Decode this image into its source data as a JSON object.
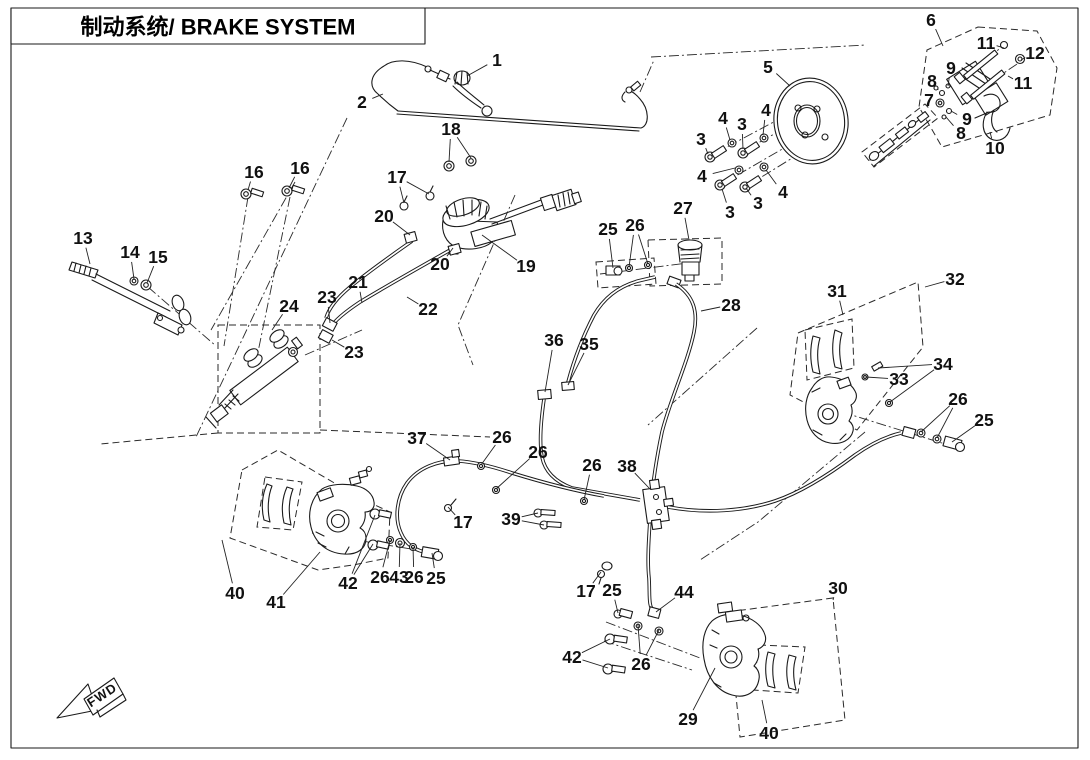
{
  "title": {
    "zh": "制动系统",
    "en": "BRAKE SYSTEM",
    "full": "制动系统/ BRAKE SYSTEM"
  },
  "fwd_label": "FWD",
  "colors": {
    "ink": "#1a1a1a",
    "background": "#ffffff"
  },
  "callouts": [
    {
      "n": "1",
      "x": 497,
      "y": 60,
      "t": [
        [
          467,
          76
        ]
      ]
    },
    {
      "n": "2",
      "x": 362,
      "y": 102,
      "t": [
        [
          383,
          94
        ]
      ]
    },
    {
      "n": "18",
      "x": 451,
      "y": 129,
      "t": [
        [
          449,
          162
        ],
        [
          471,
          158
        ]
      ]
    },
    {
      "n": "17",
      "x": 397,
      "y": 177,
      "t": [
        [
          404,
          203
        ],
        [
          429,
          194
        ]
      ]
    },
    {
      "n": "16",
      "x": 254,
      "y": 172,
      "t": [
        [
          248,
          190
        ]
      ]
    },
    {
      "n": "16",
      "x": 300,
      "y": 168,
      "t": [
        [
          289,
          188
        ]
      ]
    },
    {
      "n": "20",
      "x": 384,
      "y": 216,
      "t": [
        [
          410,
          235
        ]
      ]
    },
    {
      "n": "20",
      "x": 440,
      "y": 264,
      "t": [
        [
          453,
          248
        ]
      ]
    },
    {
      "n": "19",
      "x": 526,
      "y": 266,
      "t": [
        [
          482,
          235
        ]
      ]
    },
    {
      "n": "13",
      "x": 83,
      "y": 238,
      "t": [
        [
          90,
          264
        ]
      ]
    },
    {
      "n": "14",
      "x": 130,
      "y": 252,
      "t": [
        [
          134,
          279
        ]
      ]
    },
    {
      "n": "15",
      "x": 158,
      "y": 257,
      "t": [
        [
          147,
          283
        ]
      ]
    },
    {
      "n": "24",
      "x": 289,
      "y": 306,
      "t": [
        [
          272,
          330
        ]
      ]
    },
    {
      "n": "23",
      "x": 327,
      "y": 297,
      "t": [
        [
          330,
          323
        ]
      ]
    },
    {
      "n": "21",
      "x": 358,
      "y": 282,
      "t": [
        [
          362,
          303
        ]
      ]
    },
    {
      "n": "22",
      "x": 428,
      "y": 309,
      "t": [
        [
          407,
          297
        ]
      ]
    },
    {
      "n": "23",
      "x": 354,
      "y": 352,
      "t": [
        [
          332,
          340
        ]
      ]
    },
    {
      "n": "25",
      "x": 608,
      "y": 229,
      "t": [
        [
          613,
          268
        ]
      ]
    },
    {
      "n": "26",
      "x": 635,
      "y": 225,
      "t": [
        [
          629,
          267
        ],
        [
          648,
          264
        ]
      ]
    },
    {
      "n": "27",
      "x": 683,
      "y": 208,
      "t": [
        [
          689,
          240
        ]
      ]
    },
    {
      "n": "28",
      "x": 731,
      "y": 305,
      "t": [
        [
          701,
          311
        ]
      ]
    },
    {
      "n": "5",
      "x": 768,
      "y": 67,
      "t": [
        [
          790,
          86
        ]
      ]
    },
    {
      "n": "3",
      "x": 701,
      "y": 139,
      "t": [
        [
          708,
          154
        ]
      ]
    },
    {
      "n": "4",
      "x": 723,
      "y": 118,
      "t": [
        [
          730,
          140
        ]
      ]
    },
    {
      "n": "3",
      "x": 742,
      "y": 124,
      "t": [
        [
          743,
          149
        ]
      ]
    },
    {
      "n": "4",
      "x": 766,
      "y": 110,
      "t": [
        [
          763,
          135
        ]
      ]
    },
    {
      "n": "4",
      "x": 702,
      "y": 176,
      "t": [
        [
          735,
          168
        ]
      ]
    },
    {
      "n": "3",
      "x": 730,
      "y": 212,
      "t": [
        [
          722,
          189
        ]
      ]
    },
    {
      "n": "3",
      "x": 758,
      "y": 203,
      "t": [
        [
          746,
          188
        ]
      ]
    },
    {
      "n": "4",
      "x": 783,
      "y": 192,
      "t": [
        [
          766,
          170
        ]
      ]
    },
    {
      "n": "6",
      "x": 931,
      "y": 20,
      "t": [
        [
          943,
          46
        ]
      ]
    },
    {
      "n": "11",
      "x": 986,
      "y": 43,
      "t": [
        [
          1004,
          48
        ]
      ]
    },
    {
      "n": "12",
      "x": 1035,
      "y": 53,
      "t": [
        [
          1021,
          60
        ]
      ]
    },
    {
      "n": "9",
      "x": 951,
      "y": 68,
      "t": [
        [
          948,
          86
        ]
      ]
    },
    {
      "n": "8",
      "x": 932,
      "y": 81,
      "t": [
        [
          938,
          90
        ]
      ]
    },
    {
      "n": "11",
      "x": 1023,
      "y": 83,
      "t": [
        [
          1008,
          76
        ]
      ]
    },
    {
      "n": "7",
      "x": 929,
      "y": 100,
      "t": [
        [
          939,
          103
        ]
      ]
    },
    {
      "n": "9",
      "x": 967,
      "y": 119,
      "t": [
        [
          951,
          111
        ]
      ]
    },
    {
      "n": "8",
      "x": 961,
      "y": 133,
      "t": [
        [
          946,
          117
        ]
      ]
    },
    {
      "n": "10",
      "x": 995,
      "y": 148,
      "t": [
        [
          990,
          132
        ]
      ]
    },
    {
      "n": "31",
      "x": 837,
      "y": 291,
      "t": [
        [
          843,
          315
        ]
      ]
    },
    {
      "n": "32",
      "x": 955,
      "y": 279,
      "t": [
        [
          925,
          287
        ]
      ]
    },
    {
      "n": "33",
      "x": 899,
      "y": 379,
      "t": [
        [
          866,
          377
        ]
      ]
    },
    {
      "n": "34",
      "x": 943,
      "y": 364,
      "t": [
        [
          878,
          368
        ],
        [
          890,
          402
        ]
      ]
    },
    {
      "n": "26",
      "x": 958,
      "y": 399,
      "t": [
        [
          921,
          432
        ],
        [
          937,
          438
        ]
      ]
    },
    {
      "n": "25",
      "x": 984,
      "y": 420,
      "t": [
        [
          952,
          442
        ]
      ]
    },
    {
      "n": "36",
      "x": 554,
      "y": 340,
      "t": [
        [
          545,
          392
        ]
      ]
    },
    {
      "n": "35",
      "x": 589,
      "y": 344,
      "t": [
        [
          568,
          385
        ]
      ]
    },
    {
      "n": "37",
      "x": 417,
      "y": 438,
      "t": [
        [
          450,
          460
        ]
      ]
    },
    {
      "n": "26",
      "x": 502,
      "y": 437,
      "t": [
        [
          481,
          465
        ]
      ]
    },
    {
      "n": "26",
      "x": 538,
      "y": 452,
      "t": [
        [
          496,
          489
        ]
      ]
    },
    {
      "n": "26",
      "x": 592,
      "y": 465,
      "t": [
        [
          584,
          500
        ]
      ]
    },
    {
      "n": "38",
      "x": 627,
      "y": 466,
      "t": [
        [
          650,
          489
        ]
      ]
    },
    {
      "n": "39",
      "x": 511,
      "y": 519,
      "t": [
        [
          538,
          513
        ],
        [
          544,
          525
        ]
      ]
    },
    {
      "n": "17",
      "x": 463,
      "y": 522,
      "t": [
        [
          448,
          507
        ]
      ]
    },
    {
      "n": "40",
      "x": 235,
      "y": 593,
      "t": [
        [
          222,
          540
        ]
      ]
    },
    {
      "n": "41",
      "x": 276,
      "y": 602,
      "t": [
        [
          320,
          552
        ]
      ]
    },
    {
      "n": "42",
      "x": 348,
      "y": 583,
      "t": [
        [
          375,
          515
        ],
        [
          373,
          544
        ]
      ]
    },
    {
      "n": "26",
      "x": 380,
      "y": 577,
      "t": [
        [
          390,
          540
        ]
      ]
    },
    {
      "n": "43",
      "x": 399,
      "y": 577,
      "t": [
        [
          400,
          543
        ]
      ]
    },
    {
      "n": "26",
      "x": 414,
      "y": 577,
      "t": [
        [
          413,
          547
        ]
      ]
    },
    {
      "n": "25",
      "x": 436,
      "y": 578,
      "t": [
        [
          432,
          553
        ]
      ]
    },
    {
      "n": "17",
      "x": 586,
      "y": 591,
      "t": [
        [
          601,
          572
        ]
      ]
    },
    {
      "n": "25",
      "x": 612,
      "y": 590,
      "t": [
        [
          618,
          613
        ]
      ]
    },
    {
      "n": "44",
      "x": 684,
      "y": 592,
      "t": [
        [
          656,
          612
        ]
      ]
    },
    {
      "n": "42",
      "x": 572,
      "y": 657,
      "t": [
        [
          610,
          639
        ],
        [
          608,
          668
        ]
      ]
    },
    {
      "n": "26",
      "x": 641,
      "y": 664,
      "t": [
        [
          638,
          625
        ],
        [
          659,
          630
        ]
      ]
    },
    {
      "n": "29",
      "x": 688,
      "y": 719,
      "t": [
        [
          715,
          668
        ]
      ]
    },
    {
      "n": "40",
      "x": 769,
      "y": 733,
      "t": [
        [
          762,
          700
        ]
      ]
    },
    {
      "n": "30",
      "x": 838,
      "y": 588,
      "t": [
        [
          833,
          600
        ]
      ]
    }
  ]
}
